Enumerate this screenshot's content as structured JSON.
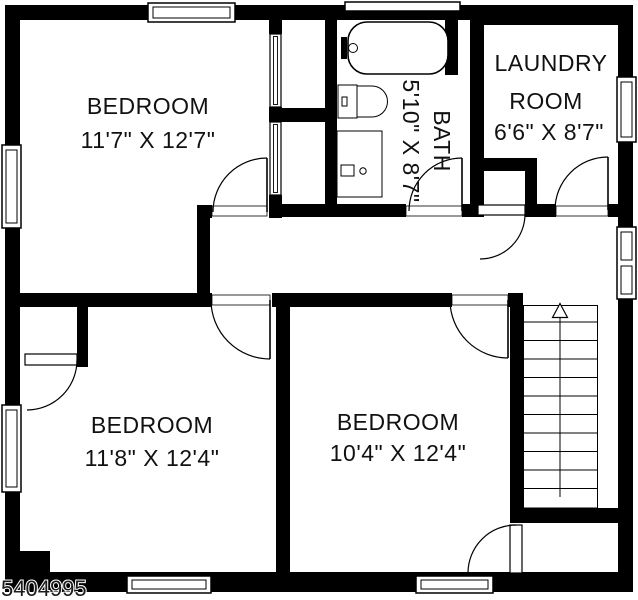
{
  "plan": {
    "type": "floor-plan",
    "floor_background": "#ffffff",
    "wall_color": "#000000",
    "text_color": "#111111"
  },
  "rooms": {
    "bedroom_top_left": {
      "name": "BEDROOM",
      "dimensions": "11'7\" X 12'7\""
    },
    "bedroom_bottom_left": {
      "name": "BEDROOM",
      "dimensions": "11'8\" X 12'4\""
    },
    "bedroom_bottom_right": {
      "name": "BEDROOM",
      "dimensions": "10'4\" X 12'4\""
    },
    "bath": {
      "name": "BATH",
      "dimensions": "5'10\" X 8'7\""
    },
    "laundry": {
      "name_line1": "LAUNDRY",
      "name_line2": "ROOM",
      "dimensions": "6'6\" X 8'7\""
    }
  },
  "stairs": {
    "arrow_direction": "up"
  },
  "watermark": "5404995"
}
